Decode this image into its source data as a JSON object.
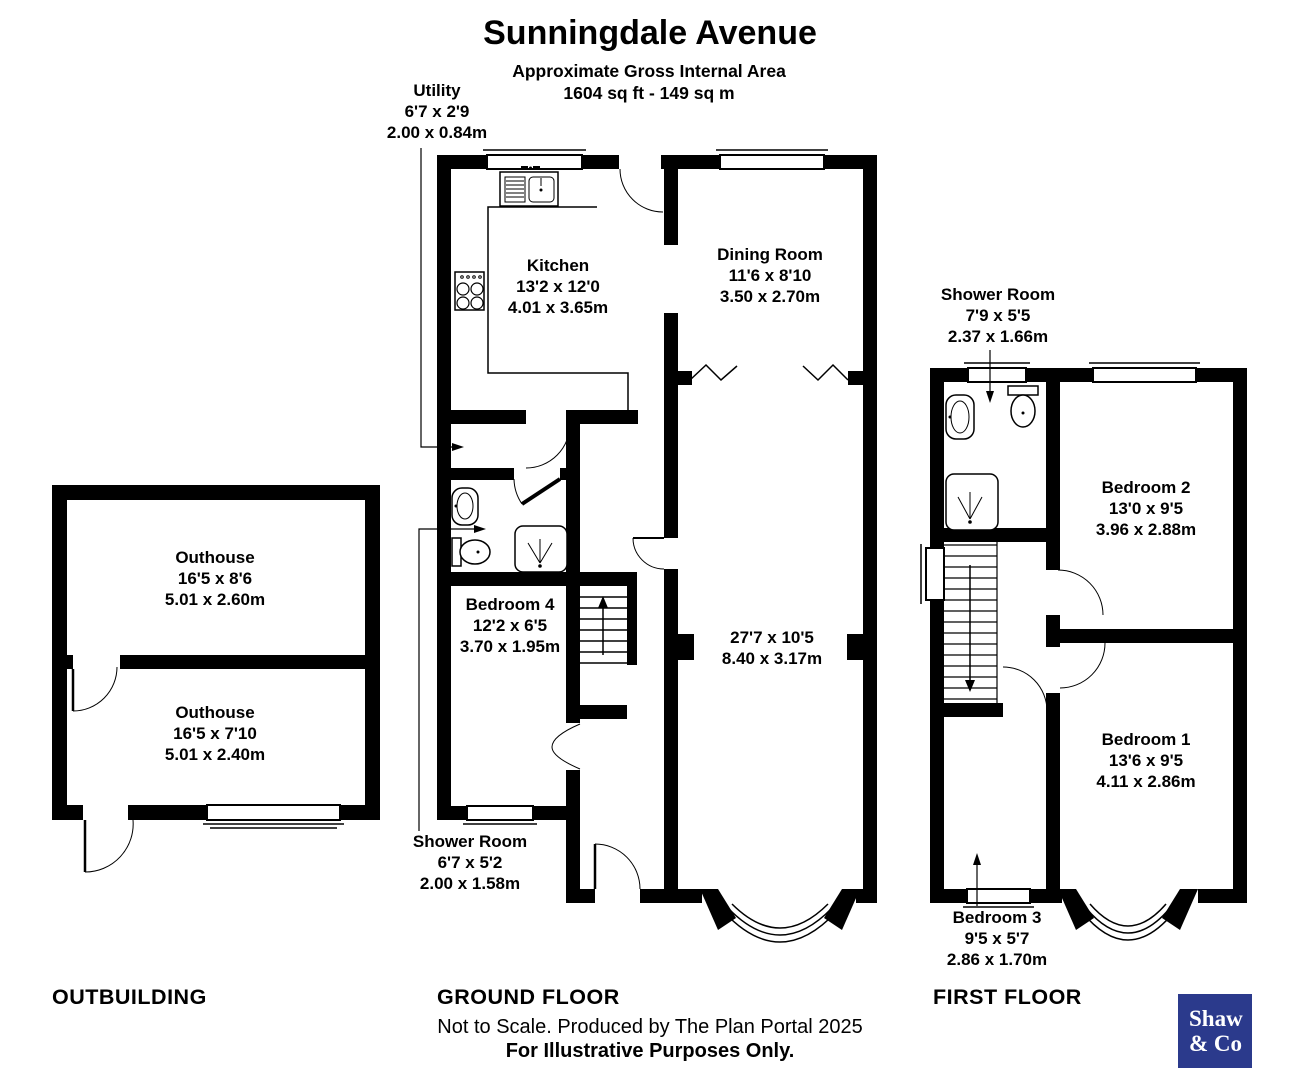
{
  "header": {
    "title": "Sunningdale Avenue",
    "area_label": "Approximate Gross Internal Area",
    "area_value": "1604 sq ft - 149 sq m"
  },
  "rooms": {
    "utility": {
      "name": "Utility",
      "ft": "6'7 x 2'9",
      "m": "2.00 x 0.84m"
    },
    "kitchen": {
      "name": "Kitchen",
      "ft": "13'2 x 12'0",
      "m": "4.01 x 3.65m"
    },
    "dining": {
      "name": "Dining Room",
      "ft": "11'6 x 8'10",
      "m": "3.50 x 2.70m"
    },
    "living": {
      "ft": "27'7 x 10'5",
      "m": "8.40 x 3.17m"
    },
    "bedroom4": {
      "name": "Bedroom 4",
      "ft": "12'2 x 6'5",
      "m": "3.70 x 1.95m"
    },
    "gf_shower": {
      "name": "Shower Room",
      "ft": "6'7 x 5'2",
      "m": "2.00 x 1.58m"
    },
    "outhouse_a": {
      "name": "Outhouse",
      "ft": "16'5 x 8'6",
      "m": "5.01 x 2.60m"
    },
    "outhouse_b": {
      "name": "Outhouse",
      "ft": "16'5 x 7'10",
      "m": "5.01 x 2.40m"
    },
    "ff_shower": {
      "name": "Shower Room",
      "ft": "7'9 x 5'5",
      "m": "2.37 x 1.66m"
    },
    "bedroom2": {
      "name": "Bedroom 2",
      "ft": "13'0 x 9'5",
      "m": "3.96 x 2.88m"
    },
    "bedroom1": {
      "name": "Bedroom 1",
      "ft": "13'6 x 9'5",
      "m": "4.11 x 2.86m"
    },
    "bedroom3": {
      "name": "Bedroom 3",
      "ft": "9'5 x 5'7",
      "m": "2.86 x 1.70m"
    }
  },
  "sections": {
    "outbuilding": "OUTBUILDING",
    "ground": "GROUND FLOOR",
    "first": "FIRST FLOOR"
  },
  "footer": {
    "line1": "Not to Scale. Produced by The Plan Portal 2025",
    "line2": "For Illustrative Purposes Only."
  },
  "logo": {
    "line1": "Shaw",
    "line2": "& Co",
    "bg": "#2b3a8c"
  }
}
